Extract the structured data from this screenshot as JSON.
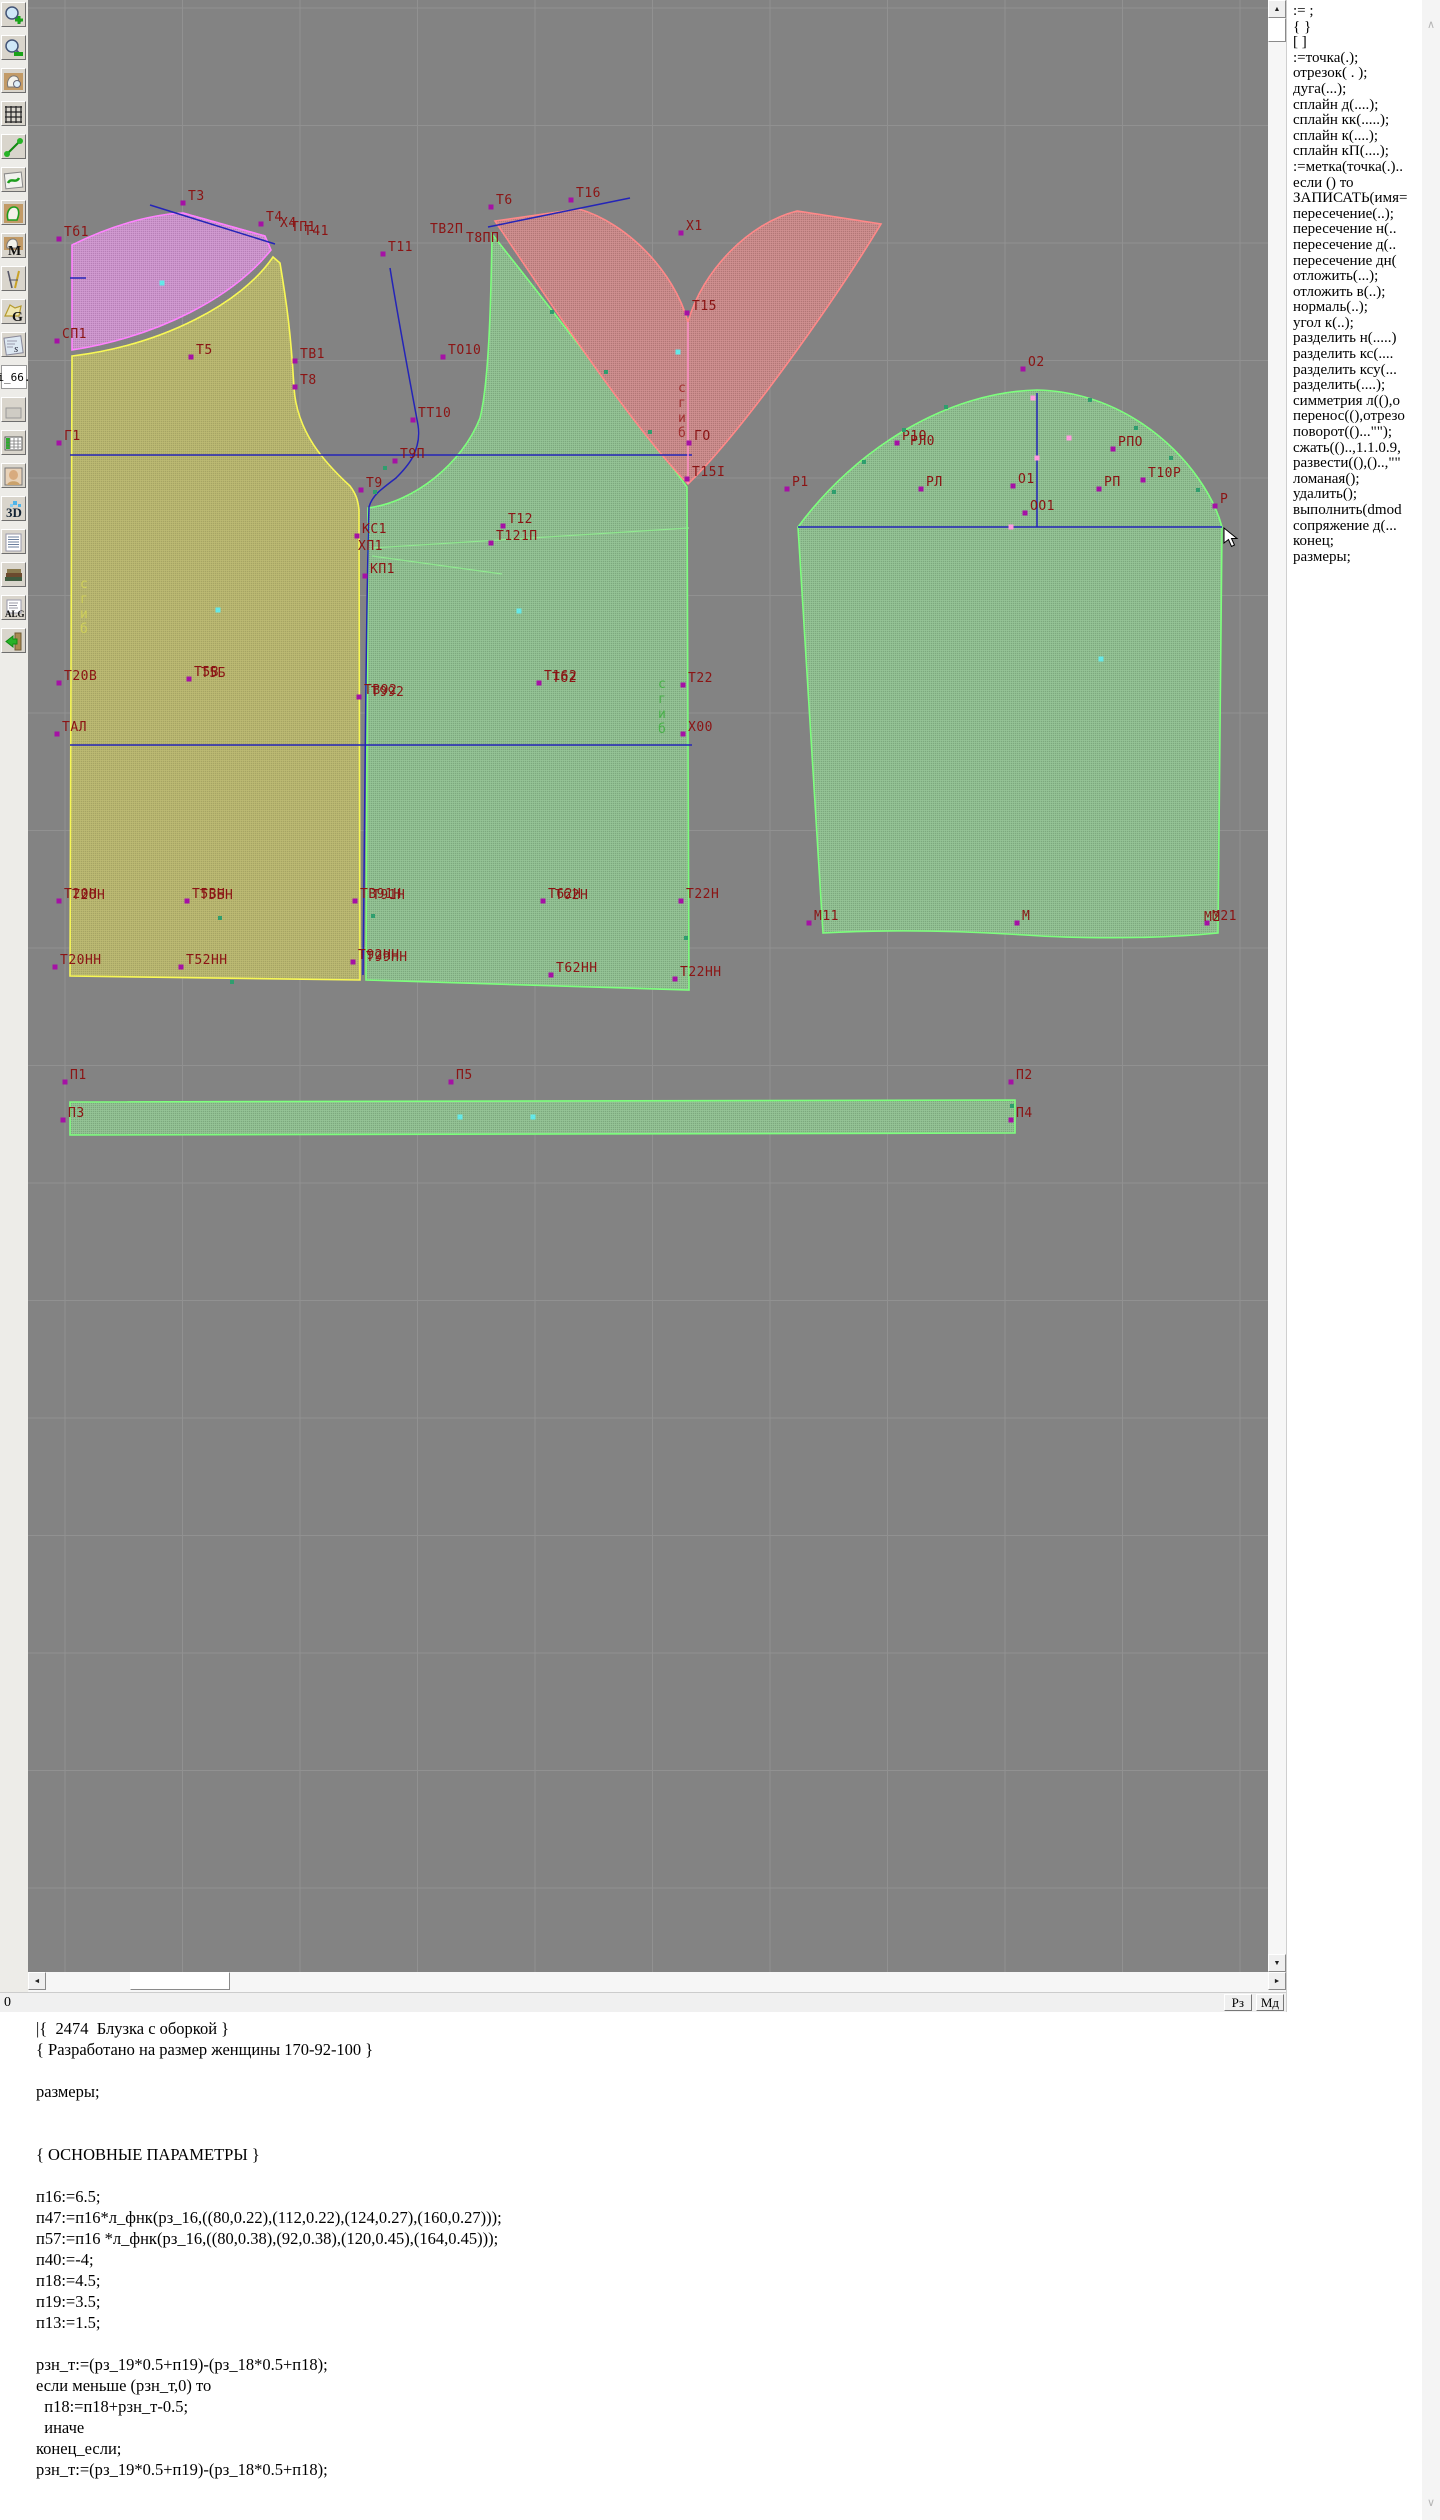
{
  "colors": {
    "canvas_bg": "#838383",
    "grid": "#919191",
    "label": "#8b1414",
    "outline_yellow": "#f8f855",
    "outline_purple": "#ff82ff",
    "outline_green": "#7dff7d",
    "outline_red": "#ff8888",
    "line_blue": "#2424b8",
    "fold_pink": "#ff8fc8",
    "dart_green": "#8fe88f",
    "marker_magenta": "#a511a5",
    "marker_cyan": "#63e8e8",
    "marker_teal": "#2f9e6e",
    "marker_pink": "#ff9ade"
  },
  "toolbar": {
    "items": [
      {
        "name": "zoom-in-icon"
      },
      {
        "name": "zoom-out-icon"
      },
      {
        "name": "pattern-sheet-icon"
      },
      {
        "name": "grid-icon"
      },
      {
        "name": "measure-icon"
      },
      {
        "name": "sketch-sheet-icon"
      },
      {
        "name": "pattern-outline-icon"
      },
      {
        "name": "pattern-m-icon",
        "letter": "M"
      },
      {
        "name": "drafting-tools-icon"
      },
      {
        "name": "pattern-g-icon",
        "letter": "G"
      },
      {
        "name": "ruler-s-icon",
        "letter": "s"
      },
      {
        "name": "index-label",
        "label": "i_66."
      },
      {
        "name": "spacer-icon"
      },
      {
        "name": "table-icon"
      },
      {
        "name": "portrait-icon"
      },
      {
        "name": "3d-icon",
        "letter": "3D"
      },
      {
        "name": "list-icon"
      },
      {
        "name": "books-icon"
      },
      {
        "name": "alg-icon",
        "letter": "ALG"
      },
      {
        "name": "exit-icon"
      }
    ]
  },
  "command_panel": {
    "items": [
      ":= ;",
      "{  }",
      "[  ]",
      ":=точка(.);",
      "отрезок( . );",
      "дуга(...);",
      "сплайн  д(....);",
      "сплайн  кк(.....);",
      "сплайн  к(....);",
      "сплайн  кП(....);",
      ":=метка(точка(.)..",
      "если () то",
      "ЗАПИСАТЬ(имя=",
      "пересечение(..);",
      "пересечение  н(..",
      "пересечение  д(..",
      "пересечение  дн(",
      "отложить(...);",
      "отложить  в(..);",
      "нормаль(..);",
      "угол  к(..);",
      "разделить  н(.....)",
      "разделить  кс(....",
      "разделить  ксу(...",
      "разделить(....);",
      "симметрия  л((),о",
      "перенос((),отрезо",
      "поворот(()...\"\");",
      "сжать(()..,1.1.0.9,",
      "развести((),()..,\"\"",
      "ломаная();",
      "удалить();",
      "выполнить(dmod",
      "сопряжение  д(...",
      "конец;",
      "размеры;"
    ]
  },
  "statusbar": {
    "left": "0",
    "mode_buttons": [
      "Рз",
      "Мд"
    ]
  },
  "code_editor": {
    "lines": [
      "|{  2474  Блузка с оборкой }",
      "{ Разработано на размер женщины 170-92-100 }",
      "",
      "размеры;",
      "",
      "",
      "{ ОСНОВНЫЕ ПАРАМЕТРЫ }",
      "",
      "п16:=6.5;",
      "п47:=п16*л_фнк(рз_16,((80,0.22),(112,0.22),(124,0.27),(160,0.27)));",
      "п57:=п16 *л_фнк(рз_16,((80,0.38),(92,0.38),(120,0.45),(164,0.45)));",
      "п40:=-4;",
      "п18:=4.5;",
      "п19:=3.5;",
      "п13:=1.5;",
      "",
      "рзн_т:=(рз_19*0.5+п19)-(рз_18*0.5+п18);",
      "если меньше (рзн_т,0) то",
      "  п18:=п18+рзн_т-0.5;",
      "  иначе",
      "конец_если;",
      "рзн_т:=(рз_19*0.5+п19)-(рз_18*0.5+п18);"
    ]
  },
  "canvas": {
    "labels": [
      {
        "t": "Т3",
        "x": 160,
        "y": 200,
        "pt": 1
      },
      {
        "t": "Т4",
        "x": 238,
        "y": 221,
        "pt": 1
      },
      {
        "t": "Х4",
        "x": 252,
        "y": 227
      },
      {
        "t": "ТП1",
        "x": 263,
        "y": 231
      },
      {
        "t": "Т41",
        "x": 276,
        "y": 235
      },
      {
        "t": "Т6",
        "x": 468,
        "y": 204,
        "pt": 1
      },
      {
        "t": "Т16",
        "x": 548,
        "y": 197,
        "pt": 1
      },
      {
        "t": "Тб1",
        "x": 36,
        "y": 236,
        "pt": 1
      },
      {
        "t": "ТВ2П",
        "x": 402,
        "y": 233
      },
      {
        "t": "Т8ПП",
        "x": 438,
        "y": 242
      },
      {
        "t": "Т11",
        "x": 360,
        "y": 251,
        "pt": 1
      },
      {
        "t": "Х1",
        "x": 658,
        "y": 230,
        "pt": 1
      },
      {
        "t": "Т15",
        "x": 664,
        "y": 310,
        "pt": 1
      },
      {
        "t": "СП1",
        "x": 34,
        "y": 338,
        "pt": 1
      },
      {
        "t": "Т5",
        "x": 168,
        "y": 354,
        "pt": 1
      },
      {
        "t": "ТВ1",
        "x": 272,
        "y": 358,
        "pt": 1
      },
      {
        "t": "Т8",
        "x": 272,
        "y": 384,
        "pt": 1
      },
      {
        "t": "ТО10",
        "x": 420,
        "y": 354,
        "pt": 1
      },
      {
        "t": "ТТ10",
        "x": 390,
        "y": 417,
        "pt": 1
      },
      {
        "t": "Г1",
        "x": 36,
        "y": 440,
        "pt": 1
      },
      {
        "t": "ГО",
        "x": 666,
        "y": 440,
        "pt": 1
      },
      {
        "t": "Т9П",
        "x": 372,
        "y": 458,
        "pt": 1
      },
      {
        "t": "Т15І",
        "x": 664,
        "y": 476,
        "pt": 1
      },
      {
        "t": "Т9",
        "x": 338,
        "y": 487,
        "pt": 1
      },
      {
        "t": "Т12",
        "x": 480,
        "y": 523,
        "pt": 1
      },
      {
        "t": "Т121П",
        "x": 468,
        "y": 540,
        "pt": 1
      },
      {
        "t": "КС1",
        "x": 334,
        "y": 533,
        "pt": 1
      },
      {
        "t": "ХП1",
        "x": 330,
        "y": 550
      },
      {
        "t": "КП1",
        "x": 342,
        "y": 573,
        "pt": 1
      },
      {
        "t": "Т20В",
        "x": 36,
        "y": 680,
        "pt": 1
      },
      {
        "t": "Т5В",
        "x": 166,
        "y": 676,
        "pt": 1
      },
      {
        "t": "Т5Б",
        "x": 173,
        "y": 677
      },
      {
        "t": "ТВ92",
        "x": 336,
        "y": 694,
        "pt": 1
      },
      {
        "t": "Т992",
        "x": 343,
        "y": 696
      },
      {
        "t": "Т162",
        "x": 516,
        "y": 680,
        "pt": 1
      },
      {
        "t": "Тб2",
        "x": 524,
        "y": 682
      },
      {
        "t": "Т22",
        "x": 660,
        "y": 682,
        "pt": 1
      },
      {
        "t": "ТАЛ",
        "x": 34,
        "y": 731,
        "pt": 1
      },
      {
        "t": "Х00",
        "x": 660,
        "y": 731,
        "pt": 1
      },
      {
        "t": "Т20Н",
        "x": 36,
        "y": 898,
        "pt": 1
      },
      {
        "t": "Т2ОН",
        "x": 44,
        "y": 899
      },
      {
        "t": "Т5ВН",
        "x": 164,
        "y": 898,
        "pt": 1
      },
      {
        "t": "Т5БН",
        "x": 172,
        "y": 899
      },
      {
        "t": "ТВ91Н",
        "x": 332,
        "y": 898,
        "pt": 1
      },
      {
        "t": "Т91Н",
        "x": 344,
        "y": 899
      },
      {
        "t": "Т62Н",
        "x": 520,
        "y": 898,
        "pt": 1
      },
      {
        "t": "Тб2Н",
        "x": 527,
        "y": 899
      },
      {
        "t": "Т22Н",
        "x": 658,
        "y": 898,
        "pt": 1
      },
      {
        "t": "Т20НН",
        "x": 32,
        "y": 964,
        "pt": 1
      },
      {
        "t": "Т52НН",
        "x": 158,
        "y": 964,
        "pt": 1
      },
      {
        "t": "Т92НН",
        "x": 330,
        "y": 959,
        "pt": 1
      },
      {
        "t": "Т99НН",
        "x": 338,
        "y": 961
      },
      {
        "t": "Т62НН",
        "x": 528,
        "y": 972,
        "pt": 1
      },
      {
        "t": "Т22НН",
        "x": 652,
        "y": 976,
        "pt": 1
      },
      {
        "t": "О2",
        "x": 1000,
        "y": 366,
        "pt": 1
      },
      {
        "t": "Р1О",
        "x": 874,
        "y": 440,
        "pt": 1
      },
      {
        "t": "РЛ0",
        "x": 882,
        "y": 445
      },
      {
        "t": "Р1",
        "x": 764,
        "y": 486,
        "pt": 1
      },
      {
        "t": "РЛ",
        "x": 898,
        "y": 486,
        "pt": 1
      },
      {
        "t": "О1",
        "x": 990,
        "y": 483,
        "pt": 1
      },
      {
        "t": "ОО1",
        "x": 1002,
        "y": 510,
        "pt": 1
      },
      {
        "t": "РП",
        "x": 1076,
        "y": 486,
        "pt": 1
      },
      {
        "t": "РПО",
        "x": 1090,
        "y": 446,
        "pt": 1
      },
      {
        "t": "Т10Р",
        "x": 1120,
        "y": 477,
        "pt": 1
      },
      {
        "t": "Р",
        "x": 1192,
        "y": 503,
        "pt": 1
      },
      {
        "t": "М11",
        "x": 786,
        "y": 920,
        "pt": 1
      },
      {
        "t": "М",
        "x": 994,
        "y": 920,
        "pt": 1
      },
      {
        "t": "М21",
        "x": 1184,
        "y": 920,
        "pt": 1
      },
      {
        "t": "М2",
        "x": 1176,
        "y": 921
      },
      {
        "t": "П1",
        "x": 42,
        "y": 1079,
        "pt": 1
      },
      {
        "t": "П5",
        "x": 428,
        "y": 1079,
        "pt": 1
      },
      {
        "t": "П2",
        "x": 988,
        "y": 1079,
        "pt": 1
      },
      {
        "t": "П3",
        "x": 40,
        "y": 1117,
        "pt": 1
      },
      {
        "t": "П4",
        "x": 988,
        "y": 1117,
        "pt": 1
      }
    ],
    "vertical_labels": [
      {
        "t": "сгиб",
        "x": 52,
        "y": 588,
        "color": "#cfcf5a"
      },
      {
        "t": "сгиб",
        "x": 650,
        "y": 392,
        "color": "#a03030"
      },
      {
        "t": "сгиб",
        "x": 630,
        "y": 688,
        "color": "#49b049"
      }
    ],
    "markers": {
      "cyan": [
        [
          134,
          283
        ],
        [
          190,
          610
        ],
        [
          491,
          611
        ],
        [
          1073,
          659
        ],
        [
          650,
          352
        ],
        [
          432,
          1117
        ],
        [
          505,
          1117
        ]
      ],
      "teal": [
        [
          806,
          492
        ],
        [
          836,
          462
        ],
        [
          876,
          430
        ],
        [
          918,
          407
        ],
        [
          1062,
          400
        ],
        [
          1108,
          428
        ],
        [
          1143,
          458
        ],
        [
          1170,
          490
        ],
        [
          347,
          492
        ],
        [
          357,
          468
        ],
        [
          524,
          312
        ],
        [
          578,
          372
        ],
        [
          622,
          432
        ],
        [
          204,
          982
        ],
        [
          345,
          916
        ],
        [
          658,
          938
        ],
        [
          192,
          918
        ],
        [
          984,
          1106
        ]
      ],
      "pink": [
        [
          1009,
          458
        ],
        [
          983,
          527
        ],
        [
          1041,
          438
        ],
        [
          1005,
          398
        ]
      ]
    },
    "cursor": {
      "x": 1196,
      "y": 528
    }
  }
}
